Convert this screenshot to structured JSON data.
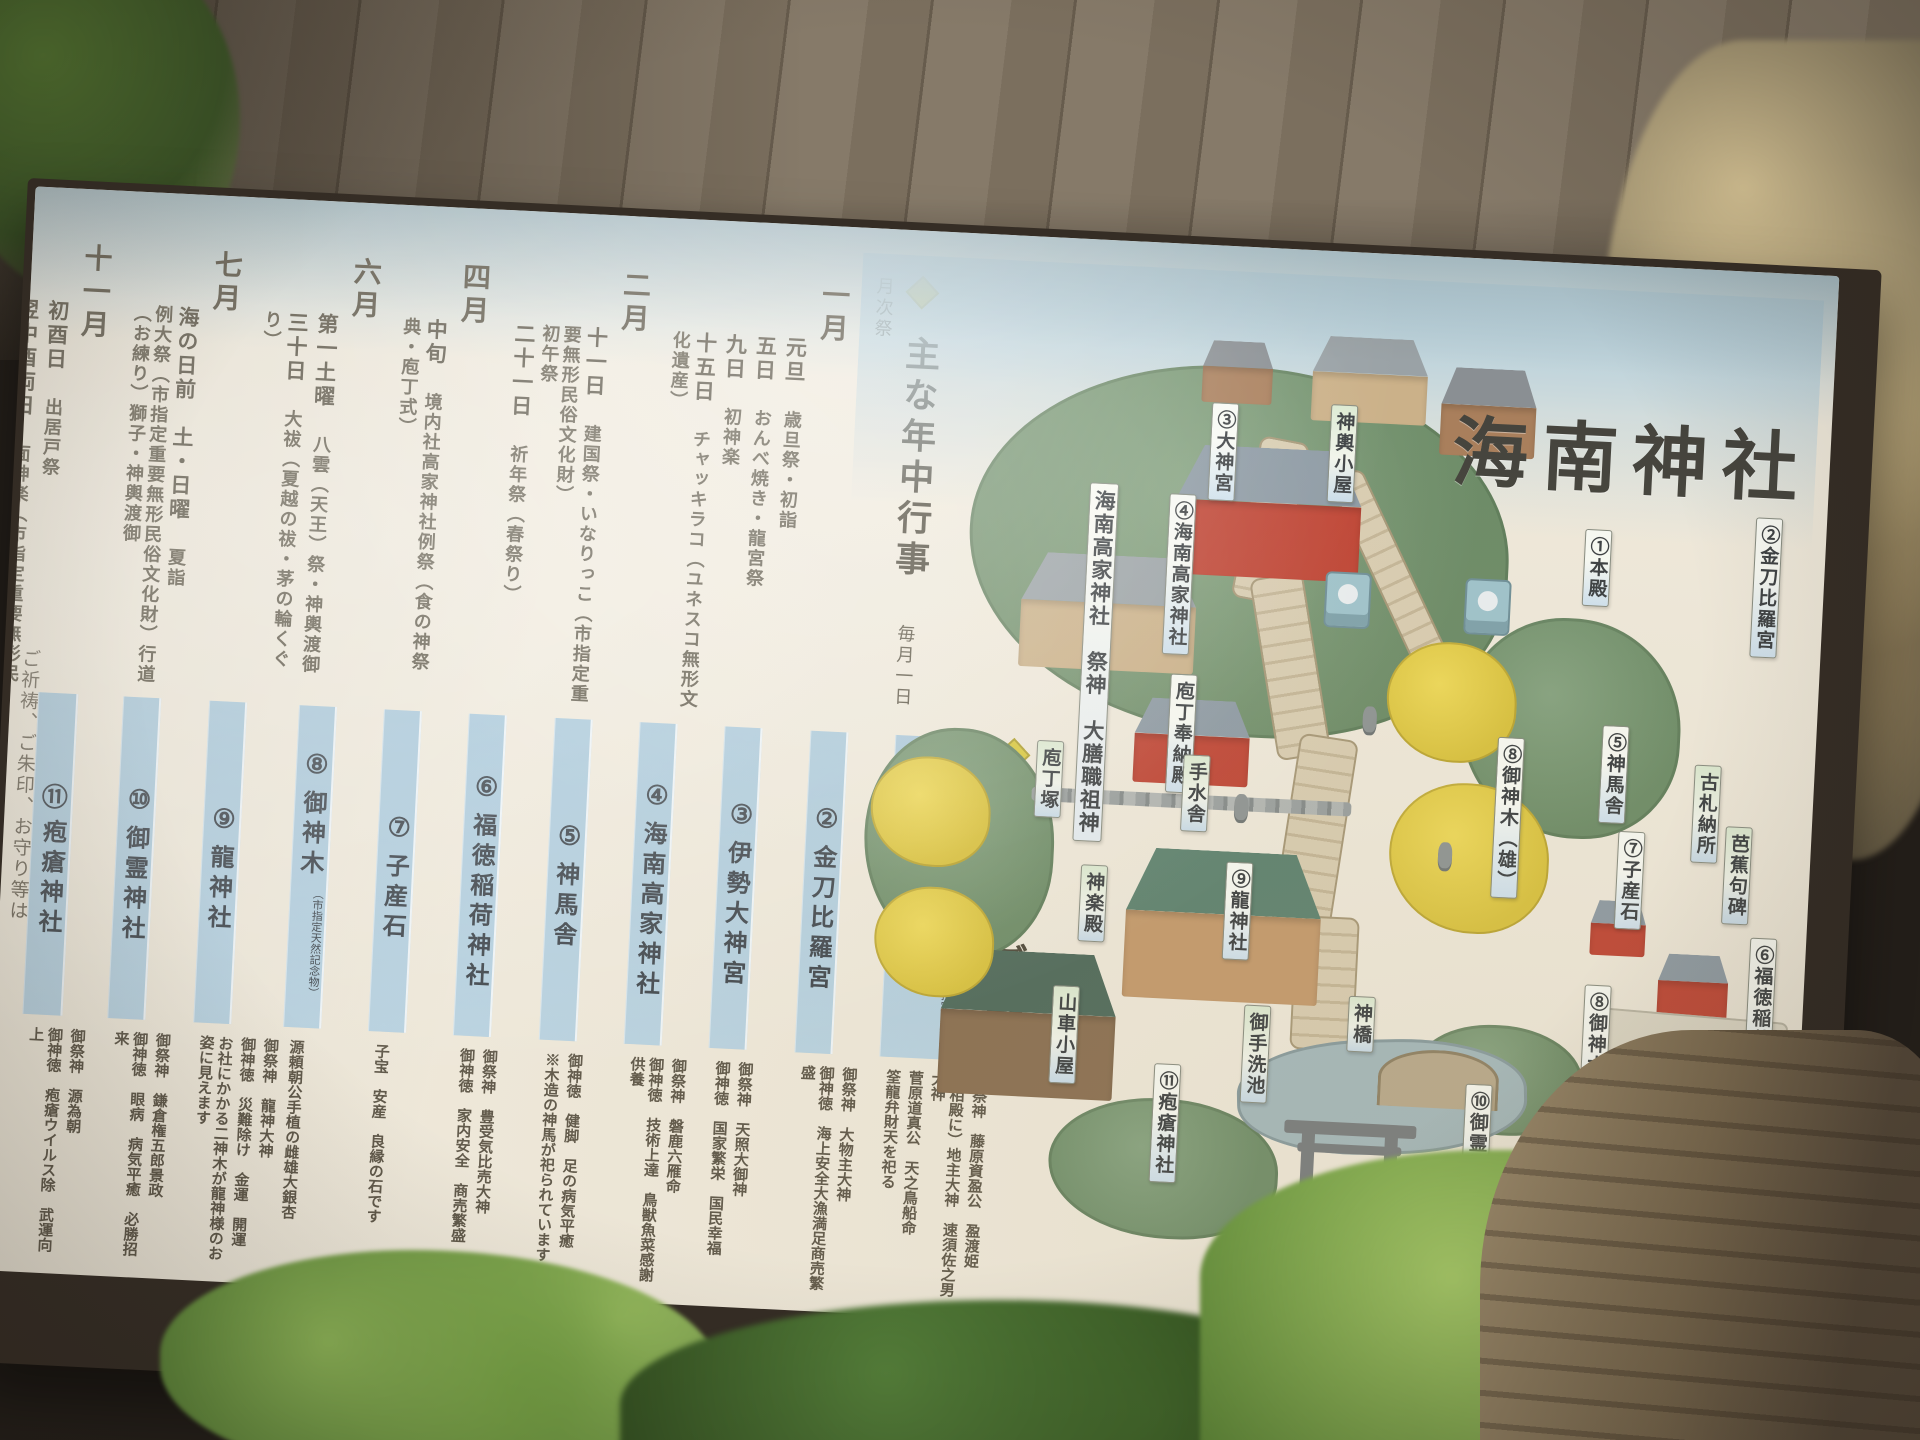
{
  "board": {
    "title": "海南神社",
    "prayer_note": "ご祈祷、ご朱印、お守り等は",
    "colors": {
      "board_bg": "#efe9db",
      "sky_blue": "#b4cfdc",
      "band_blue": "#a9c8da",
      "accent_diamond": "#d9c83c",
      "text": "#57513f",
      "tag_green": "#dcead2",
      "tag_blue": "#cfe1ee",
      "main_hall_red": "#bf4434",
      "ginkgo_yellow": "#d9c23f"
    },
    "events": {
      "header": "主な年中行事",
      "subheader": "毎月一日　月次祭",
      "months": [
        {
          "name": "一月",
          "entries": [
            {
              "date": "元旦",
              "event": "歳旦祭・初詣"
            },
            {
              "date": "五日",
              "event": "おんべ焼き・龍宮祭"
            },
            {
              "date": "九日",
              "event": "初神楽"
            },
            {
              "date": "十五日",
              "event": "チャッキラコ（ユネスコ無形文化遺産）"
            }
          ]
        },
        {
          "name": "二月",
          "entries": [
            {
              "date": "十一日",
              "event": "建国祭・いなりっこ（市指定重要無形民俗文化財）"
            },
            {
              "date": "",
              "event": "初午祭"
            },
            {
              "date": "二十一日",
              "event": "祈年祭（春祭り）"
            }
          ]
        },
        {
          "name": "四月",
          "entries": [
            {
              "date": "中旬",
              "event": "境内社高家神社例祭（食の神祭典・庖丁式）"
            }
          ]
        },
        {
          "name": "六月",
          "entries": [
            {
              "date": "第一土曜",
              "event": "八雲（天王）祭・神輿渡御"
            },
            {
              "date": "三十日",
              "event": "大祓（夏越の祓・茅の輪くぐり）"
            }
          ]
        },
        {
          "name": "七月",
          "entries": [
            {
              "date": "海の日前　土・日曜",
              "event": "夏詣"
            },
            {
              "date": "",
              "event": "例大祭（市指定重要無形民俗文化財）行道（お練り）獅子・神輿渡御"
            }
          ]
        },
        {
          "name": "十一月",
          "entries": [
            {
              "date": "初酉日",
              "event": "出居戸祭"
            },
            {
              "date": "翌中酉両日",
              "event": "面神楽（市指定重要無形民俗文化財）"
            },
            {
              "date": "二十五日",
              "event": "新嘗祭（秋祭り）"
            },
            {
              "date": "七五三",
              "event": ""
            }
          ]
        },
        {
          "name": "十二月",
          "entries": [
            {
              "date": "十五日",
              "event": "酉の市"
            },
            {
              "date": "三十一日",
              "event": "大祓（年越の祓い）除夜祭"
            }
          ]
        }
      ]
    },
    "guide": {
      "header": "境内のご案内",
      "items": [
        {
          "num": "①",
          "name": "本殿幣殿",
          "sub": "及び拝殿",
          "note": "（市指定重要文化財）",
          "desc": [
            "御祭神　藤原資盈公　盈渡姫",
            "（相殿に）地主大神　速須佐之男大神",
            "菅原道真公　天之鳥船命",
            "筌龍弁財天を祀る"
          ]
        },
        {
          "num": "②",
          "name": "金刀比羅宮",
          "sub": "",
          "note": "",
          "desc": [
            "御祭神　大物主大神",
            "御神徳　海上安全大漁満足商売繁盛"
          ]
        },
        {
          "num": "③",
          "name": "伊勢大神宮",
          "sub": "",
          "note": "",
          "desc": [
            "御祭神　天照大御神",
            "御神徳　国家繁栄　国民幸福"
          ]
        },
        {
          "num": "④",
          "name": "海南高家神社",
          "sub": "",
          "note": "",
          "desc": [
            "御祭神　磐鹿六雁命",
            "御神徳　技術上達　鳥獣魚菜感謝供養"
          ]
        },
        {
          "num": "⑤",
          "name": "神馬舎",
          "sub": "",
          "note": "",
          "desc": [
            "御神徳　健脚　足の病気平癒",
            "※木造の神馬が祀られています"
          ]
        },
        {
          "num": "⑥",
          "name": "福徳稲荷神社",
          "sub": "",
          "note": "",
          "desc": [
            "御祭神　豊受気比売大神",
            "御神徳　家内安全　商売繁盛"
          ]
        },
        {
          "num": "⑦",
          "name": "子産石",
          "sub": "",
          "note": "",
          "desc": [
            "子宝　安産　良縁の石です"
          ]
        },
        {
          "num": "⑧",
          "name": "御神木",
          "sub": "",
          "note": "（市指定天然記念物）",
          "desc": [
            "源頼朝公手植の雌雄大銀杏"
          ]
        },
        {
          "num": "⑨",
          "name": "龍神社",
          "sub": "",
          "note": "",
          "desc": [
            "御祭神　龍神大神",
            "御神徳　災難除け　金運　開運",
            "お社にかかる二神木が龍神様のお姿に見えます"
          ]
        },
        {
          "num": "⑩",
          "name": "御霊神社",
          "sub": "",
          "note": "",
          "desc": [
            "御祭神　鎌倉権五郎景政",
            "御神徳　眼病　病気平癒　必勝招来"
          ]
        },
        {
          "num": "⑪",
          "name": "疱瘡神社",
          "sub": "",
          "note": "",
          "desc": [
            "御祭神　源為朝",
            "御神徳　疱瘡ウイルス除　武運向上"
          ]
        }
      ]
    },
    "map": {
      "parking_letter": "P",
      "labels": [
        {
          "text": "神輿小屋",
          "kind": "g",
          "x": 475,
          "y": 128
        },
        {
          "text": "③大神宮",
          "kind": "b",
          "x": 356,
          "y": 132
        },
        {
          "text": "④海南高家神社",
          "kind": "b",
          "x": 318,
          "y": 225
        },
        {
          "text": "海南高家神社　祭神　大膳職祖神",
          "kind": "w",
          "x": 238,
          "y": 218
        },
        {
          "text": "庖丁奉納殿",
          "kind": "b",
          "x": 328,
          "y": 405
        },
        {
          "text": "庖丁塚",
          "kind": "g",
          "x": 198,
          "y": 478
        },
        {
          "text": "①本殿",
          "kind": "b",
          "x": 735,
          "y": 240
        },
        {
          "text": "②金刀比羅宮",
          "kind": "b",
          "x": 905,
          "y": 220
        },
        {
          "text": "⑤神馬舎",
          "kind": "b",
          "x": 762,
          "y": 435
        },
        {
          "text": "古札納所",
          "kind": "g",
          "x": 856,
          "y": 470
        },
        {
          "text": "⑧御神木（雄）",
          "kind": "b",
          "x": 658,
          "y": 452
        },
        {
          "text": "芭蕉句碑",
          "kind": "g",
          "x": 890,
          "y": 530
        },
        {
          "text": "⑦子産石",
          "kind": "b",
          "x": 783,
          "y": 540
        },
        {
          "text": "⑥福徳稲荷神社",
          "kind": "b",
          "x": 920,
          "y": 640
        },
        {
          "text": "手水舎",
          "kind": "g",
          "x": 345,
          "y": 485
        },
        {
          "text": "⑨龍神社",
          "kind": "b",
          "x": 393,
          "y": 590
        },
        {
          "text": "神楽殿",
          "kind": "g",
          "x": 248,
          "y": 600
        },
        {
          "text": "神橋",
          "kind": "g",
          "x": 522,
          "y": 718
        },
        {
          "text": "御手洗池",
          "kind": "g",
          "x": 418,
          "y": 732
        },
        {
          "text": "山車小屋",
          "kind": "g",
          "x": 226,
          "y": 722
        },
        {
          "text": "⑧御神木（雌）",
          "kind": "b",
          "x": 757,
          "y": 695
        },
        {
          "text": "駐車場",
          "kind": "g",
          "x": 912,
          "y": 750
        },
        {
          "text": "⑩御霊神社",
          "kind": "b",
          "x": 643,
          "y": 800
        },
        {
          "text": "⑪疱瘡神社",
          "kind": "b",
          "x": 331,
          "y": 795
        },
        {
          "text": "⑫社務所",
          "kind": "b",
          "x": 924,
          "y": 900
        },
        {
          "text": "休憩所",
          "kind": "g",
          "x": 842,
          "y": 915
        },
        {
          "text": "氏子会館",
          "kind": "g",
          "x": 762,
          "y": 930
        }
      ]
    }
  }
}
